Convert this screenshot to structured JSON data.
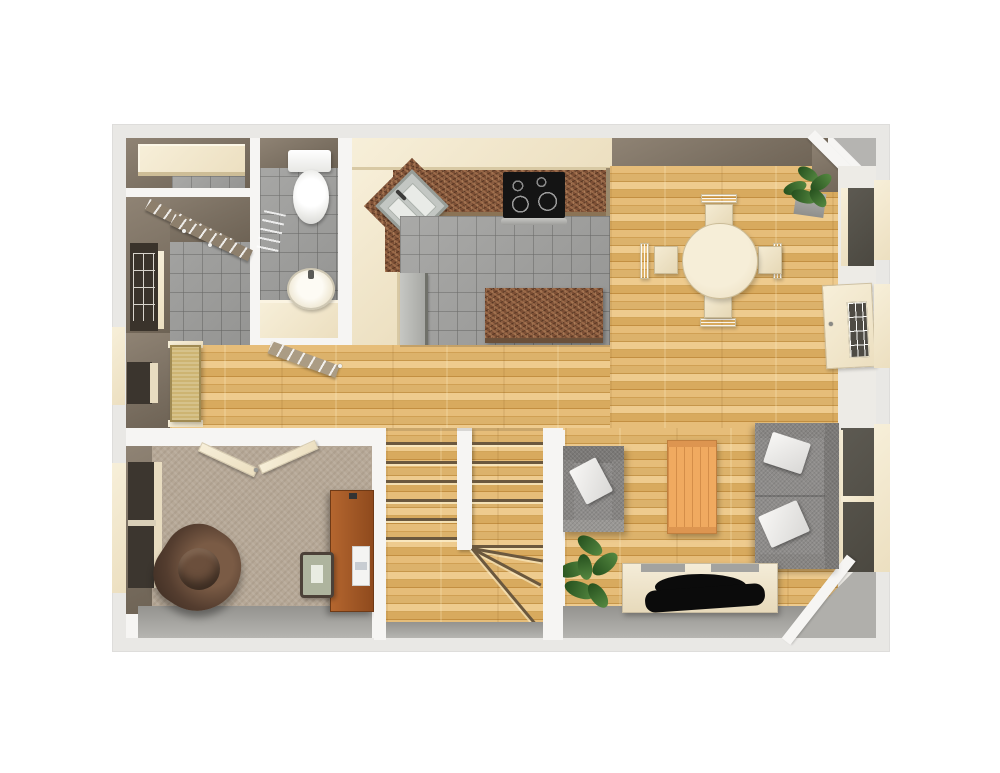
{
  "scene": {
    "type": "3d-floorplan-render",
    "view": "top-down",
    "description": "Rendered first-floor plan with kitchen, dining, living room, bathroom, office and U-shaped staircase"
  },
  "palette": {
    "page-bg": "#ffffff",
    "frame": "#e9e8e5",
    "wall": "#f6f5f3",
    "wall-face": "#7d7263",
    "wood-base": "#ddb068",
    "tile": "#a3a3a1",
    "granite": "#7c4f35",
    "carpet": "#b6a897",
    "cream": "#f2e7cd",
    "sofa-gray": "#8e8c8a",
    "glass-dark": "#55524b",
    "plant-green": "#3f6b2d",
    "desk-wood": "#a85a26",
    "chair-brown": "#46342a",
    "tv-black": "#0b0b0b",
    "table-wood": "#f0aa60"
  },
  "rooms": {
    "closet": {
      "name": "Closet",
      "floor": "tile"
    },
    "mudroom": {
      "name": "Laundry / Mudroom",
      "floor": "tile"
    },
    "bathroom": {
      "name": "Bathroom",
      "floor": "tile"
    },
    "kitchen": {
      "name": "Kitchen",
      "floor": "tile"
    },
    "dining": {
      "name": "Dining Area",
      "floor": "hardwood"
    },
    "hallway": {
      "name": "Hallway",
      "floor": "hardwood"
    },
    "office": {
      "name": "Office / Den",
      "floor": "carpet"
    },
    "stairs": {
      "name": "Staircase",
      "floor": "hardwood"
    },
    "living": {
      "name": "Living Room",
      "floor": "hardwood"
    }
  },
  "furniture": {
    "closet_shelf": {
      "name": "Closet shelf"
    },
    "closet_doors": {
      "name": "Closet double doors"
    },
    "front_door": {
      "name": "Front door"
    },
    "toilet": {
      "name": "Toilet"
    },
    "bathroom_sink": {
      "name": "Bathroom sink"
    },
    "vanity": {
      "name": "Bathroom vanity"
    },
    "bathroom_door": {
      "name": "Bathroom door"
    },
    "kitchen_sink": {
      "name": "Corner kitchen sink"
    },
    "stove": {
      "name": "Cooktop range"
    },
    "refrigerator": {
      "name": "Refrigerator"
    },
    "island": {
      "name": "Kitchen island"
    },
    "counter": {
      "name": "Granite counter"
    },
    "dining_table": {
      "name": "Round dining table"
    },
    "dining_chair": {
      "name": "Dining chair"
    },
    "dining_plant": {
      "name": "Potted plant"
    },
    "back_door": {
      "name": "Glazed back door"
    },
    "window": {
      "name": "Window"
    },
    "bench": {
      "name": "Entry bench"
    },
    "office_doors": {
      "name": "Office double doors"
    },
    "office_chair": {
      "name": "Brown armchair"
    },
    "desk": {
      "name": "Desk"
    },
    "desk_chair": {
      "name": "Desk chair"
    },
    "laptop": {
      "name": "Laptop"
    },
    "armchair": {
      "name": "Gray armchair"
    },
    "sofa": {
      "name": "Gray sofa"
    },
    "coffee_table": {
      "name": "Coffee table"
    },
    "tv_console": {
      "name": "Media console"
    },
    "tv": {
      "name": "Television"
    },
    "living_plant": {
      "name": "Potted plant"
    },
    "staircase": {
      "name": "U-shaped staircase"
    }
  }
}
